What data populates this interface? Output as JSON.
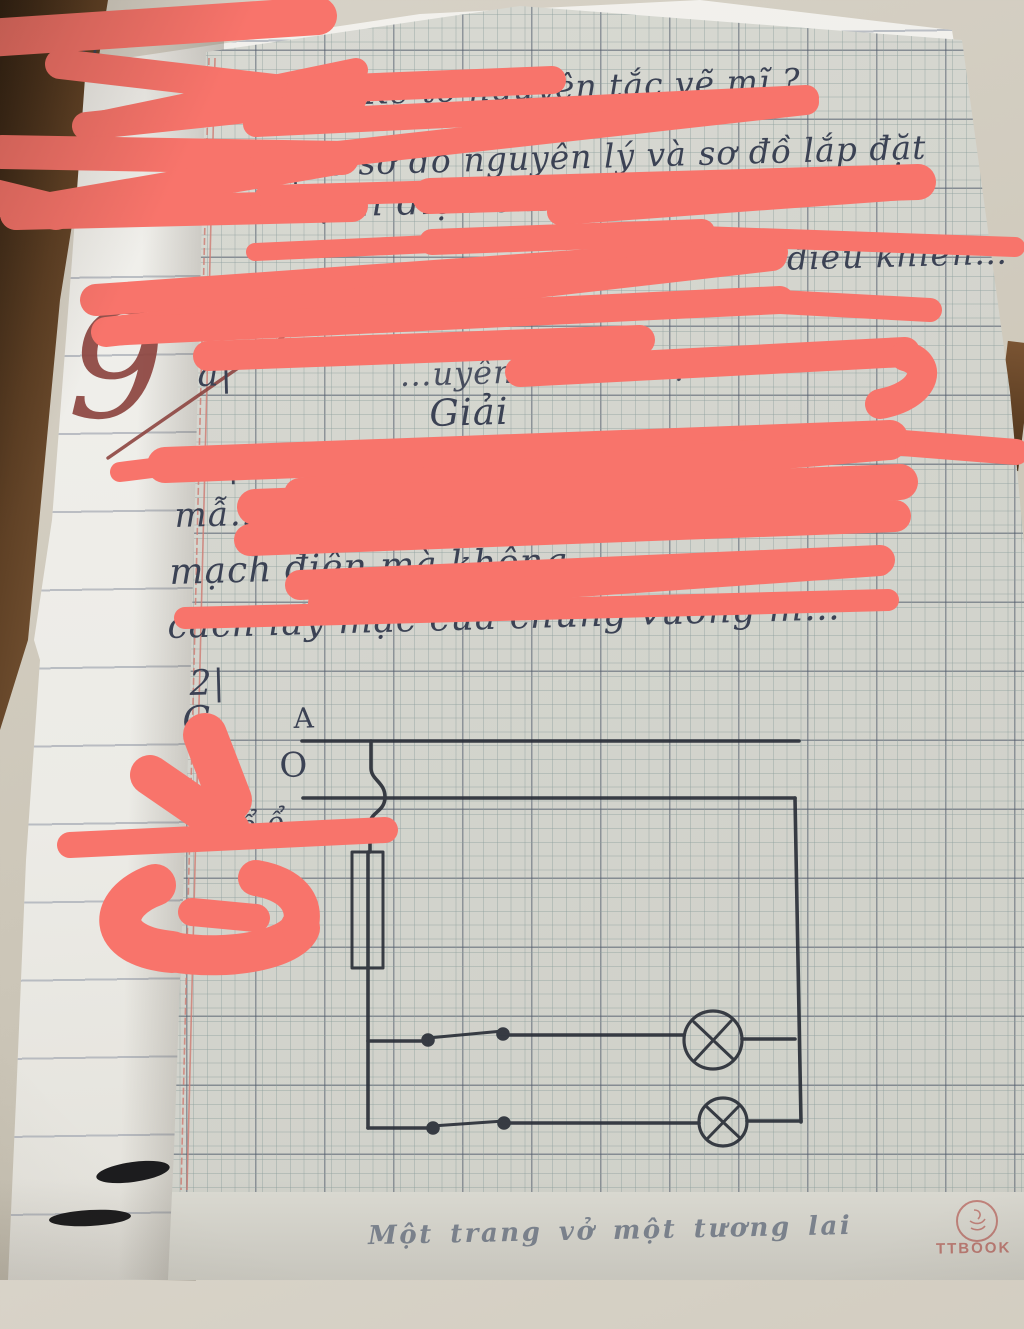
{
  "handwriting": {
    "top_fragment": "Nh",
    "question_1": "1|Kể tỏ nguyên tắc vẽ mĩ ?",
    "question_2": "2|Vẽ sơ đồ nguyên lý và sơ đồ lắp đặt",
    "question_2_cont": "mạch điện chiếu sáng…",
    "question_3_fragment": "… điều khiển…",
    "item_a": "a|",
    "item_a_fragment1": "…uyên…",
    "item_a_fragment2": "…ận trì",
    "solution_heading": "Giải",
    "solution_line1": "1|Kể tỏ…",
    "solution_line2": "mẫ…",
    "solution_line3": "mạch điện mà không …",
    "solution_line4": "cách lấy mạc của chúng vương m…",
    "item_2": "2|",
    "letter_fragment": "G",
    "margin_note": "nộp ổ ổ"
  },
  "circuit": {
    "label_phase": "A",
    "label_neutral": "O",
    "components": [
      "phase-rail",
      "neutral-rail",
      "wire-crossover",
      "fuse",
      "switch-1",
      "lamp-1",
      "switch-2",
      "lamp-2"
    ]
  },
  "grade": {
    "value": "9",
    "color": "#8d4540"
  },
  "footer": {
    "slogan": "Một trang vở một tương lai",
    "brand": "TTBOOK"
  },
  "colors": {
    "scribble": "#f8746b",
    "ink": "#3b4254",
    "circuit_ink": "#2a2f38",
    "stamp": "#c0766f",
    "grid_paper": "#d6d7d0",
    "lined_paper": "#f1f0ec",
    "table_brown": "#5d4026",
    "margin_red": "#cf8077"
  }
}
